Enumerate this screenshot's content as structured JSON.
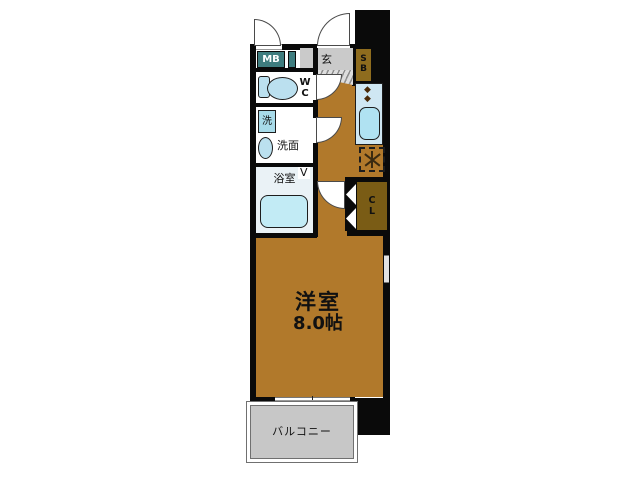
{
  "floorplan": {
    "main_room": {
      "name": "洋室",
      "area": "8.0帖"
    },
    "balcony": {
      "name": "バルコニー"
    },
    "entrance": {
      "name": "玄"
    },
    "meter_box": {
      "name": "MB"
    },
    "shoe_box": {
      "letters": [
        "S",
        "B"
      ]
    },
    "toilet": {
      "letters": [
        "W",
        "C"
      ]
    },
    "washer": {
      "name": "洗"
    },
    "washroom": {
      "name": "洗面"
    },
    "bathroom": {
      "name": "浴室",
      "door_mark": "V"
    },
    "closet": {
      "letters": [
        "C",
        "L"
      ]
    },
    "kitchen": {
      "burner_mark": "◆"
    },
    "colors": {
      "floor": "#B1792B",
      "storage_dark": "#7A5C15",
      "storage_light": "#8E6C1E",
      "meter_box": "#3F7D7F",
      "fixture_blue": "#BBE0EF",
      "counter_blue": "#CFE7F3",
      "entrance_gray": "#CACACA",
      "balcony_gray": "#C7C7C7",
      "wall": "#0A0A0A"
    }
  }
}
